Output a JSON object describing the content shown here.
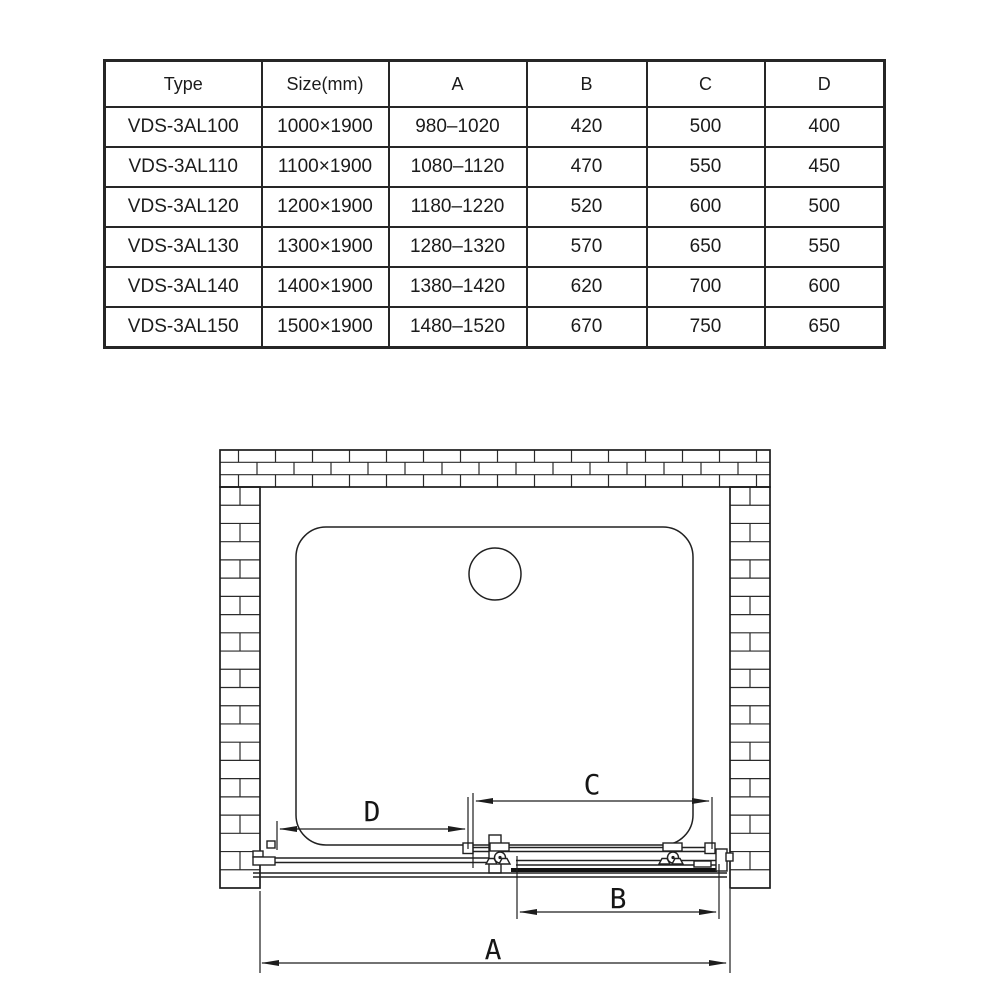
{
  "page": {
    "background": "#ffffff",
    "line_color": "#212121"
  },
  "spec_table": {
    "columns": [
      "Type",
      "Size(mm)",
      "A",
      "B",
      "C",
      "D"
    ],
    "rows": [
      [
        "VDS-3AL100",
        "1000×1900",
        "980–1020",
        "420",
        "500",
        "400"
      ],
      [
        "VDS-3AL110",
        "1100×1900",
        "1080–1120",
        "470",
        "550",
        "450"
      ],
      [
        "VDS-3AL120",
        "1200×1900",
        "1180–1220",
        "520",
        "600",
        "500"
      ],
      [
        "VDS-3AL130",
        "1300×1900",
        "1280–1320",
        "570",
        "650",
        "550"
      ],
      [
        "VDS-3AL140",
        "1400×1900",
        "1380–1420",
        "620",
        "700",
        "600"
      ],
      [
        "VDS-3AL150",
        "1500×1900",
        "1480–1520",
        "670",
        "750",
        "650"
      ]
    ]
  },
  "diagram": {
    "labels": {
      "a": "A",
      "b": "B",
      "c": "C",
      "d": "D"
    }
  }
}
